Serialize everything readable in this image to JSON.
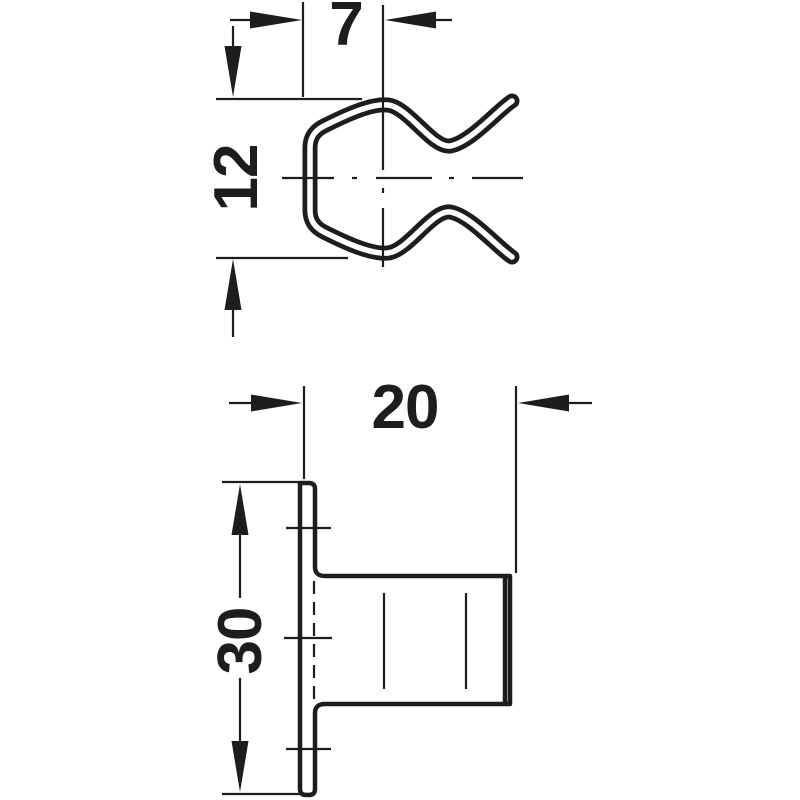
{
  "page": {
    "kind": "technical-dimension-drawing",
    "description": "Two-view dimensioned line drawing of a wire spring clip (top view) and its mounting socket with flange (bottom side view)",
    "background_color": "#ffffff"
  },
  "colors": {
    "line": "#1d1d1b",
    "background": "#ffffff"
  },
  "views": {
    "clip": {
      "name": "spring-clip-front-view",
      "dim_width": "7",
      "dim_height": "12"
    },
    "socket": {
      "name": "socket-side-view",
      "dim_depth": "20",
      "dim_height": "30"
    }
  }
}
